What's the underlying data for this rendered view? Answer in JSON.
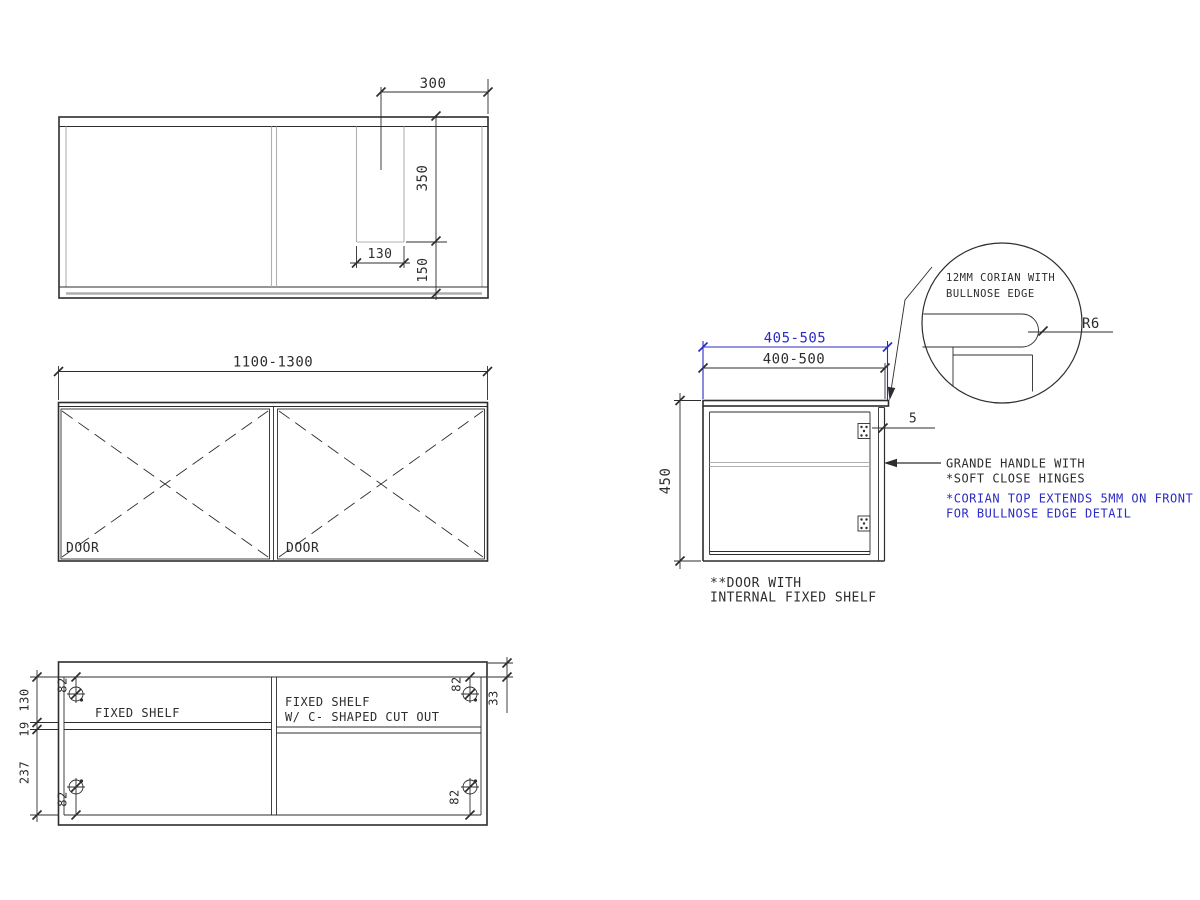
{
  "drawing": {
    "title": "vanity-cabinet-technical-drawing",
    "colors": {
      "line": "#2d2d2d",
      "light_line": "#b0b0b0",
      "accent_blue": "#2b2bc4",
      "background": "#ffffff"
    },
    "top_view": {
      "dim_300": "300",
      "dim_350": "350",
      "dim_130": "130",
      "dim_150": "150"
    },
    "front_view": {
      "dim_width": "1100-1300",
      "door_left_label": "DOOR",
      "door_right_label": "DOOR"
    },
    "bottom_view": {
      "dim_130": "130",
      "dim_19": "19",
      "dim_237": "237",
      "dim_33": "33",
      "hinge_labels": [
        "82",
        "82",
        "82",
        "82"
      ],
      "left_shelf_label": "FIXED SHELF",
      "right_shelf_label_line1": "FIXED SHELF",
      "right_shelf_label_line2": "W/ C- SHAPED CUT OUT"
    },
    "side_view": {
      "dim_corian_width": "405-505",
      "dim_cabinet_width": "400-500",
      "dim_height": "450",
      "dim_overhang": "5",
      "note_door_line1": "**DOOR WITH",
      "note_door_line2": "INTERNAL FIXED SHELF",
      "note_handle_line1": "GRANDE HANDLE WITH",
      "note_handle_line2": "*SOFT CLOSE HINGES",
      "note_corian_line1": "*CORIAN TOP EXTENDS 5MM ON FRONT",
      "note_corian_line2": "FOR BULLNOSE EDGE DETAIL"
    },
    "detail_circle": {
      "note_line1": "12MM CORIAN WITH",
      "note_line2": "BULLNOSE EDGE",
      "dim_radius": "R6"
    }
  }
}
